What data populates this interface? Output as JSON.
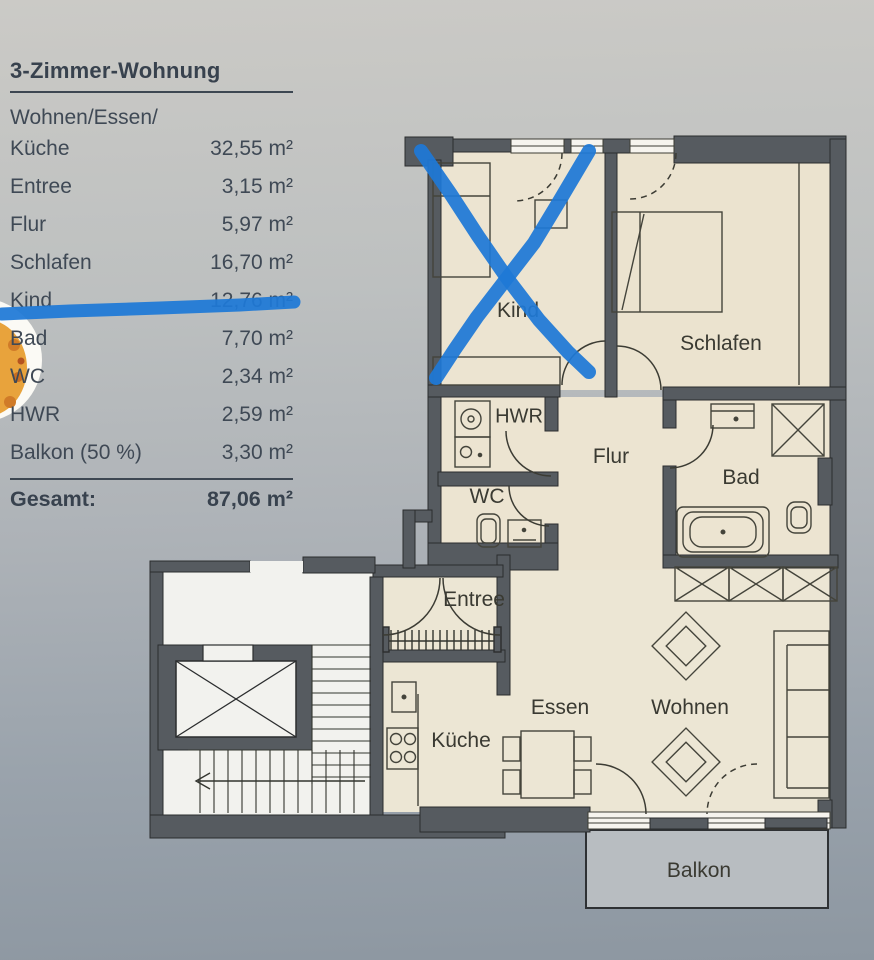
{
  "area_table": {
    "title": "3-Zimmer-Wohnung",
    "rows": [
      {
        "label": "Wohnen/Essen/",
        "value": ""
      },
      {
        "label": "Küche",
        "value": "32,55 m²"
      },
      {
        "label": "Entree",
        "value": "3,15 m²"
      },
      {
        "label": "Flur",
        "value": "5,97 m²"
      },
      {
        "label": "Schlafen",
        "value": "16,70 m²"
      },
      {
        "label": "Kind",
        "value": "12,76 m²",
        "crossed_out": true
      },
      {
        "label": "Bad",
        "value": "7,70 m²"
      },
      {
        "label": "WC",
        "value": "2,34 m²"
      },
      {
        "label": "HWR",
        "value": "2,59 m²"
      },
      {
        "label": "Balkon (50 %)",
        "value": "3,30 m²"
      }
    ],
    "total": {
      "label": "Gesamt:",
      "value": "87,06 m²"
    }
  },
  "floorplan": {
    "room_labels": {
      "kind": "Kind",
      "schlafen": "Schlafen",
      "hwr": "HWR",
      "flur": "Flur",
      "bad": "Bad",
      "wc": "WC",
      "entree": "Entree",
      "kueche": "Küche",
      "essen": "Essen",
      "wohnen": "Wohnen",
      "balkon": "Balkon"
    }
  },
  "annotations": {
    "marker_color": "#1e78d6",
    "crossed_out_room": "Kind",
    "crossed_out_table_row": "Kind 12,76 m²"
  },
  "colors": {
    "wall": "#565b60",
    "floor": "#ece4d1",
    "stairwell": "#f2f2ee",
    "balcony": "#b8bdc1",
    "page_top": "#cbcac6",
    "page_bottom": "#8d97a1",
    "table_text": "#3f4955"
  }
}
